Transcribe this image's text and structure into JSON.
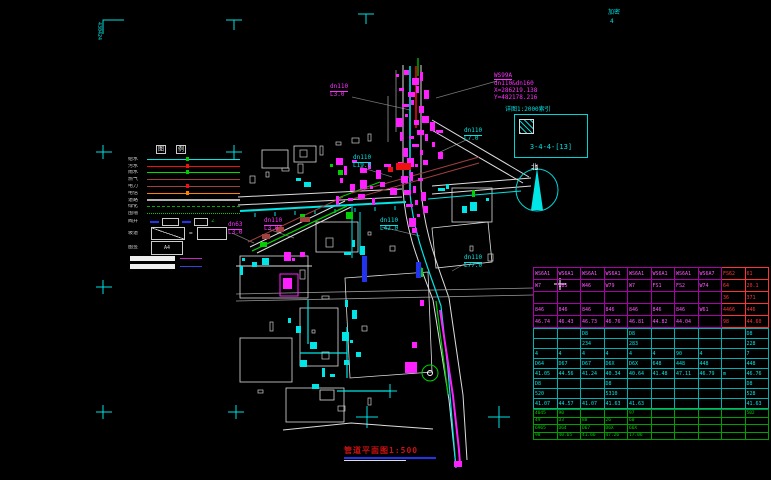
{
  "page": {
    "corner_tl_text": "430424",
    "title": "管道平面图1:500"
  },
  "map": {
    "north": "北",
    "coord": {
      "l1": "WS99A",
      "l2": "dn110&dn160",
      "l3": "X=286219.138",
      "l4": "Y=482178.216"
    },
    "index": {
      "label": "详图1:2000索引",
      "code": "3-4-4-[13]"
    },
    "labels": [
      {
        "text": "dn110",
        "x": 330,
        "y": 84,
        "color": "#ff30ff",
        "u": true
      },
      {
        "text": "L3.0",
        "x": 330,
        "y": 92,
        "color": "#ff30ff"
      },
      {
        "text": "dn110",
        "x": 464,
        "y": 128,
        "color": "#00e5e5",
        "u": true
      },
      {
        "text": "L7.0",
        "x": 464,
        "y": 136,
        "color": "#00e5e5"
      },
      {
        "text": "dn110",
        "x": 353,
        "y": 155,
        "color": "#00e5e5",
        "u": true
      },
      {
        "text": "L19.0",
        "x": 353,
        "y": 163,
        "color": "#00e5e5"
      },
      {
        "text": "dn110",
        "x": 380,
        "y": 218,
        "color": "#00e5e5",
        "u": true
      },
      {
        "text": "L42.0",
        "x": 380,
        "y": 226,
        "color": "#00e5e5"
      },
      {
        "text": "dn110",
        "x": 464,
        "y": 255,
        "color": "#00e5e5",
        "u": true
      },
      {
        "text": "L77.0",
        "x": 464,
        "y": 263,
        "color": "#00e5e5"
      },
      {
        "text": "dn63",
        "x": 228,
        "y": 222,
        "color": "#ff30ff",
        "u": true
      },
      {
        "text": "L3.0",
        "x": 228,
        "y": 230,
        "color": "#ff30ff"
      },
      {
        "text": "dn110",
        "x": 264,
        "y": 218,
        "color": "#ff30ff",
        "u": true
      },
      {
        "text": "L3.0",
        "x": 264,
        "y": 226,
        "color": "#ff30ff"
      },
      {
        "text": "加密",
        "x": 608,
        "y": 10,
        "color": "#00e0e0"
      },
      {
        "text": "4",
        "x": 610,
        "y": 19,
        "color": "#00e0e0"
      }
    ]
  },
  "legend": {
    "header": [
      "图",
      "例"
    ],
    "rows": [
      {
        "label": "给水",
        "color": "#00e5e5",
        "style": "solid",
        "tick": "#00cc00"
      },
      {
        "label": "污水",
        "color": "#ee1111",
        "style": "solid",
        "tick": "#ee1111"
      },
      {
        "label": "雨水",
        "color": "#00dd00",
        "style": "solid",
        "tick": "#00cc00"
      },
      {
        "label": "燃气",
        "color": "#a04040",
        "style": "solid"
      },
      {
        "label": "电力",
        "color": "#a04040",
        "style": "solid",
        "tick": "#ee1111"
      },
      {
        "label": "电信",
        "color": "#ff8000",
        "style": "solid",
        "tick": "#ff8000"
      },
      {
        "label": "道路",
        "color": "#b0b0b0",
        "style": "solid",
        "thick": true
      },
      {
        "label": "绿化",
        "color": "#00aa00",
        "style": "dashed"
      },
      {
        "label": "围墙",
        "color": "#00cc00",
        "style": "dotted"
      }
    ],
    "symbols_label": "阀井",
    "angle_glyph": "∠",
    "slope_label": "坡道",
    "equals_glyph": "=",
    "sheet_label": "图签",
    "sheet_text": "A4"
  },
  "table": {
    "blocks": [
      {
        "name": "node-block-magenta",
        "rows": [
          [
            "WS6A1",
            "WS6A1",
            "WS6A1",
            "WS6A1",
            "WS6A1",
            "WS6A1",
            "WS6A1",
            "WS6A7",
            "FS62",
            "61"
          ],
          [
            "W7",
            "W85",
            "W46",
            "W79",
            "W7",
            "FS1",
            "FS2",
            "W74",
            "64",
            "20.1"
          ],
          [
            "",
            "",
            "",
            "",
            "",
            "",
            "",
            "",
            "36",
            "371"
          ],
          [
            "846",
            "846",
            "846",
            "846",
            "846",
            "846",
            "846",
            "W61",
            "4466",
            "446"
          ],
          [
            "46.74",
            "46.43",
            "46.73",
            "46.76",
            "46.81",
            "44.82",
            "44.04",
            "",
            "98",
            "44.60"
          ]
        ]
      },
      {
        "name": "node-block-cyan",
        "rows": [
          [
            "",
            "",
            "D8",
            "",
            "D8",
            "",
            "",
            "",
            "",
            "D8"
          ],
          [
            "",
            "",
            "234",
            "",
            "283",
            "",
            "",
            "",
            "",
            "228"
          ],
          [
            "4",
            "4",
            "4",
            "4",
            "4",
            "4",
            "90",
            "4",
            "",
            "7"
          ],
          [
            "D64",
            "D67",
            "D67",
            "D6X",
            "D6X",
            "648",
            "448",
            "448",
            "",
            "448"
          ],
          [
            "41.05",
            "44.56",
            "41.24",
            "40.34",
            "40.64",
            "41.48",
            "47.11",
            "46.79",
            "m",
            "46.76"
          ],
          [
            "D8",
            "",
            "",
            "D8",
            "",
            "",
            "",
            "",
            "",
            "D8"
          ],
          [
            "520",
            "",
            "",
            "5310",
            "",
            "",
            "",
            "",
            "",
            "528"
          ],
          [
            "41.07",
            "44.57",
            "41.07",
            "41.63",
            "41.63",
            "",
            "",
            "",
            "",
            "41.63"
          ]
        ]
      },
      {
        "name": "node-block-green",
        "rows": [
          [
            "4045",
            "90",
            "",
            "",
            "97",
            "",
            "",
            "",
            "",
            "502"
          ],
          [
            "49",
            "D3",
            "88",
            "26",
            "60",
            "",
            "",
            "",
            "",
            ""
          ],
          [
            "6965",
            "D64",
            "D67",
            "D6X",
            "66X",
            "",
            "",
            "",
            "",
            ""
          ],
          [
            "98",
            "40.65",
            "41.66",
            "47.26",
            "17.06",
            "",
            "",
            "",
            "",
            ""
          ]
        ]
      }
    ]
  }
}
